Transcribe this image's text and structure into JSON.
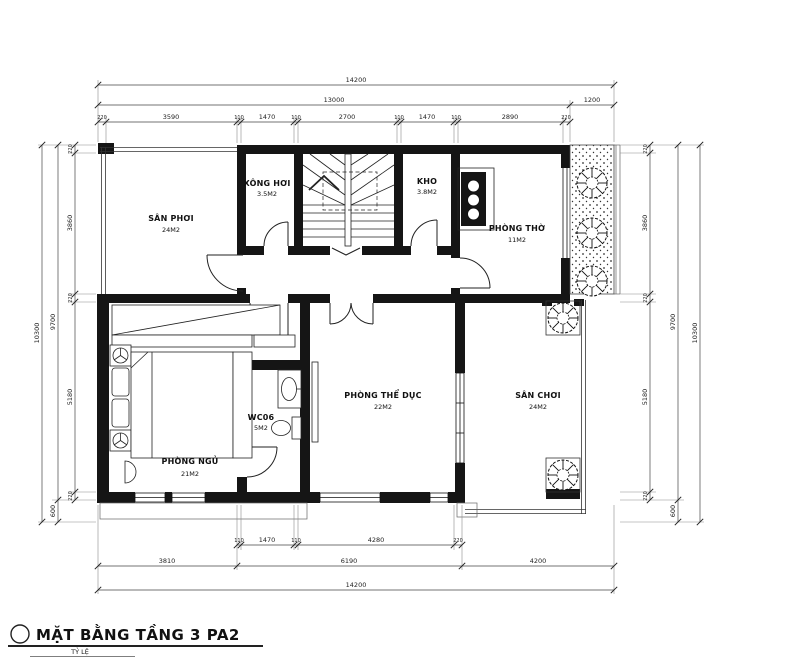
{
  "title": {
    "text": "MẶT BẰNG TẦNG 3 PA2",
    "scale_label": "TỶ LỆ"
  },
  "rooms": {
    "san_phoi": {
      "name": "SÂN PHƠI",
      "area": "24M2"
    },
    "xong_hoi": {
      "name": "XÔNG HƠI",
      "area": "3.5M2"
    },
    "kho": {
      "name": "KHO",
      "area": "3.8M2"
    },
    "phong_tho": {
      "name": "PHÒNG THỜ",
      "area": "11M2"
    },
    "phong_ngu": {
      "name": "PHÒNG NGỦ",
      "area": "21M2"
    },
    "wc": {
      "name": "WC06",
      "area": "5M2"
    },
    "phong_the_duc": {
      "name": "PHÒNG THỂ DỤC",
      "area": "22M2"
    },
    "san_choi": {
      "name": "SÂN CHƠI",
      "area": "24M2"
    }
  },
  "dims": {
    "top_total": "14200",
    "top_main": "13000",
    "top_planter": "1200",
    "top_row": [
      "220",
      "3590",
      "110",
      "1470",
      "110",
      "2700",
      "110",
      "1470",
      "110",
      "2890",
      "220"
    ],
    "left_outer": "10300",
    "left_inner": "9700",
    "left_row": [
      "220",
      "3860",
      "220",
      "5180",
      "220"
    ],
    "left_bottom": "600",
    "right_row": [
      "220",
      "3860",
      "220",
      "5180",
      "220"
    ],
    "right_bottom": "600",
    "right_inner": "9700",
    "right_outer": "10300",
    "bottom_row": [
      "110",
      "1470",
      "110",
      "4280",
      "220"
    ],
    "bottom_mid": [
      "3810",
      "6190",
      "4200"
    ],
    "bottom_total": "14200"
  },
  "colors": {
    "ink": "#1a1a1a",
    "dim_line": "#444",
    "witness": "#8a8a8a"
  }
}
